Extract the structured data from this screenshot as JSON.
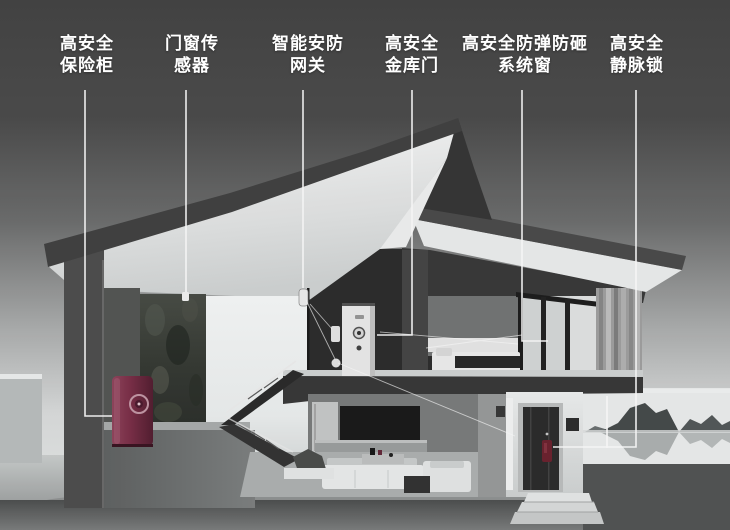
{
  "callouts": [
    {
      "id": "safe",
      "line1": "高安全",
      "line2": "保险柜",
      "target": "high-security safe"
    },
    {
      "id": "door-window-sensor",
      "line1": "门窗传",
      "line2": "感器",
      "target": "door/window sensor"
    },
    {
      "id": "security-gateway",
      "line1": "智能安防",
      "line2": "网关",
      "target": "smart security gateway"
    },
    {
      "id": "vault-door",
      "line1": "高安全",
      "line2": "金库门",
      "target": "high-security vault door"
    },
    {
      "id": "system-window",
      "line1": "高安全防弹防砸",
      "line2": "系统窗",
      "target": "bulletproof smash-proof window"
    },
    {
      "id": "vein-lock",
      "line1": "高安全",
      "line2": "静脉锁",
      "target": "vein-recognition lock"
    }
  ],
  "colors": {
    "label_text": "#ffffff",
    "leader_line": "#ffffff",
    "safe_body": "#7c3049",
    "lock_accent": "#6e2430",
    "sky_top": "#454545",
    "sky_bottom": "#eaecec"
  }
}
